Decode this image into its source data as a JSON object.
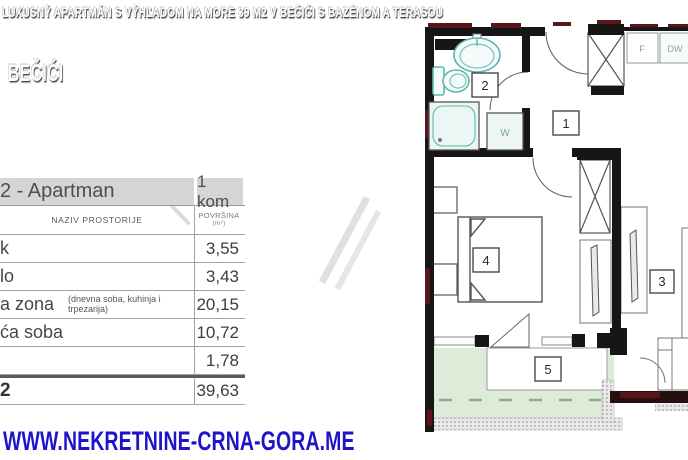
{
  "header": {
    "title": "LUXUSNÝ APARTMÁN S VÝHĽADOM NA MORE 39 M2 V BEČIĆI S BAZÉNOM A TERASOU",
    "location": "BEČIĆI"
  },
  "footer": {
    "website": "WWW.NEKRETNINE-CRNA-GORA.ME"
  },
  "table": {
    "title_fragment": "2 - Apartman",
    "count": "1 kom",
    "col_name": "NAZIV PROSTORIJE",
    "col_area": "POVRŠINA",
    "col_area_unit": "(m²)",
    "rows": [
      {
        "name": "k",
        "note": "",
        "area": "3,55"
      },
      {
        "name": "lo",
        "note": "",
        "area": "3,43"
      },
      {
        "name": "a zona",
        "note": "(dnevna soba, kuhinja i trpezarija)",
        "area": "20,15"
      },
      {
        "name": "ća soba",
        "note": "",
        "area": "10,72"
      },
      {
        "name": "",
        "note": "",
        "area": "1,78"
      }
    ],
    "total": {
      "name": "2",
      "area": "39,63"
    }
  },
  "floorplan": {
    "labels": {
      "room1": "1",
      "room2": "2",
      "room3": "3",
      "room4": "4",
      "room5": "5",
      "washer": "W",
      "fridge": "F",
      "dishwasher": "DW"
    },
    "colors": {
      "wall": "#161616",
      "wall_accent": "#5a1519",
      "fixture": "#5cb8ae",
      "terrace_green": "#ddecd8",
      "url_blue": "#1e14c8"
    }
  }
}
